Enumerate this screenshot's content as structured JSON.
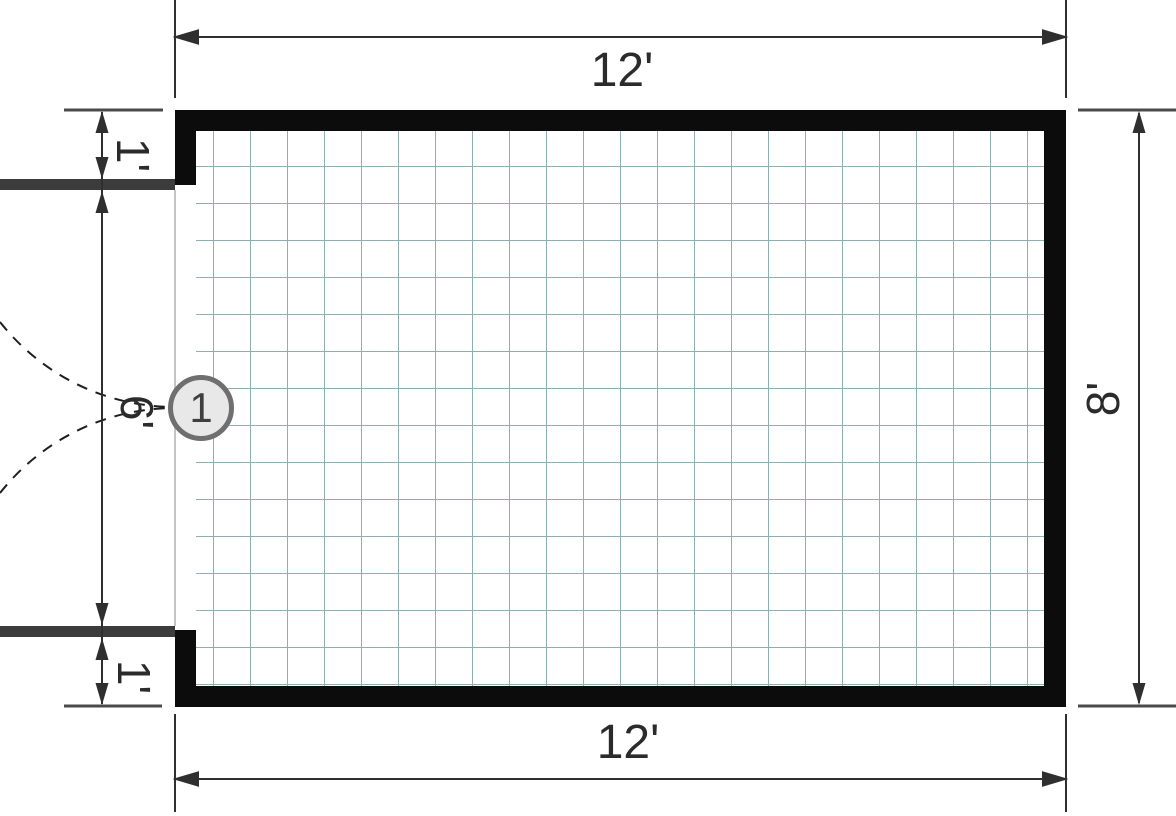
{
  "diagram": {
    "type": "floor-plan",
    "dimensions": {
      "top_width": "12'",
      "bottom_width": "12'",
      "right_height": "8'",
      "left_top_offset": "1'",
      "left_opening_width": "6'",
      "left_bottom_offset": "1'"
    },
    "door_tag": "1"
  },
  "colors": {
    "wall": "#0c0c0c",
    "door_leaf": "#3c3c3c",
    "grid_line": "#8fafaf",
    "dimension_line": "#2f2f2f",
    "extension_line": "#4a4a4a",
    "swing_arc": "#1f1f1f",
    "tag_fill": "#e8e8e8",
    "tag_border": "#6f6f6f",
    "label_text": "#2b2b2b"
  }
}
